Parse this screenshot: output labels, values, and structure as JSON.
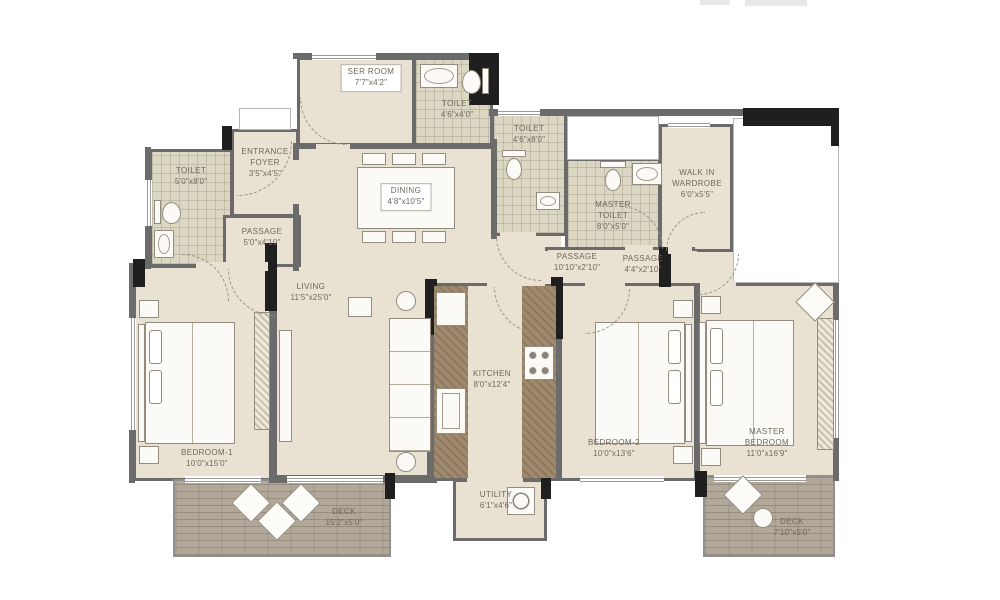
{
  "plan_type": "apartment-floor-plan",
  "colors": {
    "floor": "#e9e2d3",
    "tile": "#dcd7c3",
    "wall": "#6b6b6b",
    "column": "#1f1f1f",
    "deck_wood": "#b1a89a",
    "counter": "#a08a6e",
    "label_text": "#6f675b"
  },
  "rooms": {
    "ser_room": {
      "name": "SER ROOM",
      "dims": "7'7\"x4'2\""
    },
    "toilet_top": {
      "name": "TOILET",
      "dims": "4'6\"x4'0\""
    },
    "toilet_left": {
      "name": "TOILET",
      "dims": "5'0\"x8'0\""
    },
    "entrance_foyer": {
      "name": "ENTRANCE FOYER",
      "dims": "3'5\"x4'5\""
    },
    "passage_left": {
      "name": "PASSAGE",
      "dims": "5'0\"x4'10\""
    },
    "dining": {
      "name": "DINING",
      "dims": "4'8\"x10'5\""
    },
    "toilet_mid": {
      "name": "TOILET",
      "dims": "4'6\"x8'0\""
    },
    "master_toilet": {
      "name": "MASTER TOILET",
      "dims": "8'0\"x5'0\""
    },
    "walk_in_wardrobe": {
      "name": "WALK IN WARDROBE",
      "dims": "6'0\"x5'5\""
    },
    "passage_mid": {
      "name": "PASSAGE",
      "dims": "10'10\"x2'10\""
    },
    "passage_right": {
      "name": "PASSAGE",
      "dims": "4'4\"x2'10\""
    },
    "living": {
      "name": "LIVING",
      "dims": "11'5\"x25'0\""
    },
    "kitchen": {
      "name": "KITCHEN",
      "dims": "8'0\"x12'4\""
    },
    "utility": {
      "name": "UTILITY",
      "dims": "6'1\"x4'6\""
    },
    "bedroom1": {
      "name": "BEDROOM-1",
      "dims": "10'0\"x15'0\""
    },
    "bedroom2": {
      "name": "BEDROOM-2",
      "dims": "10'0\"x13'6\""
    },
    "master_bedroom": {
      "name": "MASTER BEDROOM",
      "dims": "11'0\"x16'9\""
    },
    "deck_left": {
      "name": "DECK",
      "dims": "15'2\"x5'0\""
    },
    "deck_right": {
      "name": "DECK",
      "dims": "7'10\"x5'0\""
    }
  }
}
